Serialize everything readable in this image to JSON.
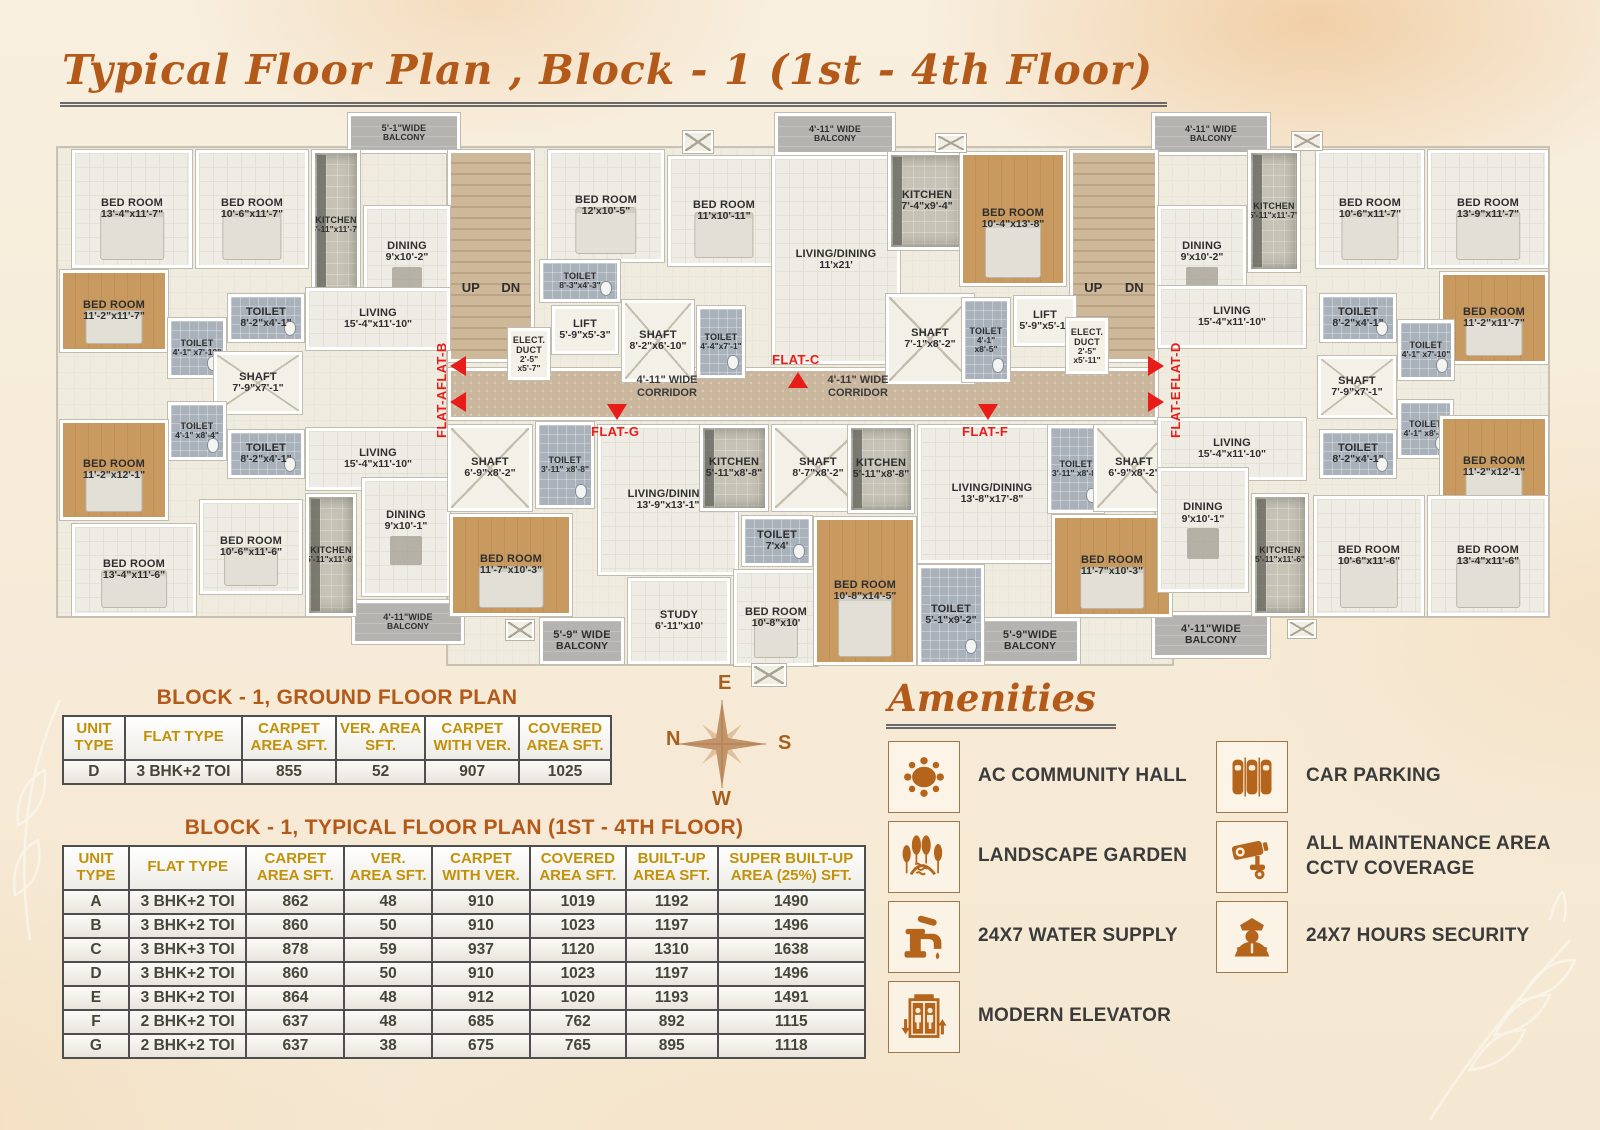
{
  "title": "Typical Floor Plan , Block - 1  (1st - 4th Floor)",
  "colors": {
    "accent": "#b35a1b",
    "red": "#e81c18",
    "table_header": "#c19209",
    "icon_brown": "#b5641c"
  },
  "floor_plan": {
    "bases": [
      {
        "x": 56,
        "y": 146,
        "w": 398,
        "h": 472
      },
      {
        "x": 446,
        "y": 146,
        "w": 714,
        "h": 262
      },
      {
        "x": 446,
        "y": 408,
        "w": 728,
        "h": 258
      },
      {
        "x": 1154,
        "y": 146,
        "w": 396,
        "h": 472
      }
    ],
    "stairs": [
      {
        "x": 448,
        "y": 150,
        "w": 86,
        "h": 212,
        "up": "UP",
        "dn": "DN"
      },
      {
        "x": 1070,
        "y": 150,
        "w": 88,
        "h": 212,
        "up": "UP",
        "dn": "DN"
      }
    ],
    "corridor": {
      "x": 448,
      "y": 368,
      "w": 710,
      "h": 52,
      "label": "4'-11\" WIDE CORRIDOR",
      "label_centers": [
        667,
        858
      ]
    },
    "rooms": [
      {
        "n": "BED ROOM",
        "d": "13'-4\"x11'-7\"",
        "x": 72,
        "y": 150,
        "w": 120,
        "h": 118,
        "t": "floor"
      },
      {
        "n": "BED ROOM",
        "d": "10'-6\"x11'-7\"",
        "x": 196,
        "y": 150,
        "w": 112,
        "h": 118,
        "t": "floor"
      },
      {
        "n": "KITCHEN",
        "d": "5'-11\"x11'-7\"",
        "x": 312,
        "y": 150,
        "w": 48,
        "h": 150,
        "t": "kitchen"
      },
      {
        "n": "DINING",
        "d": "9'x10'-2\"",
        "x": 364,
        "y": 206,
        "w": 86,
        "h": 126,
        "t": "floor",
        "c": "dining"
      },
      {
        "n": "BED ROOM",
        "d": "11'-2\"x11'-7\"",
        "x": 60,
        "y": 270,
        "w": 108,
        "h": 82,
        "t": "wood"
      },
      {
        "n": "TOILET",
        "d": "8'-2\"x4'-1\"",
        "x": 228,
        "y": 294,
        "w": 76,
        "h": 48,
        "t": "tile"
      },
      {
        "n": "TOILET",
        "d": "4'-1\" x7'-10\"",
        "x": 168,
        "y": 318,
        "w": 58,
        "h": 60,
        "t": "tile"
      },
      {
        "n": "LIVING",
        "d": "15'-4\"x11'-10\"",
        "x": 306,
        "y": 288,
        "w": 144,
        "h": 62,
        "t": "floor"
      },
      {
        "n": "SHAFT",
        "d": "7'-9\"x7'-1\"",
        "x": 214,
        "y": 352,
        "w": 88,
        "h": 62,
        "t": "shaft"
      },
      {
        "n": "TOILET",
        "d": "4'-1\" x8'-4\"",
        "x": 168,
        "y": 402,
        "w": 58,
        "h": 58,
        "t": "tile"
      },
      {
        "n": "TOILET",
        "d": "8'-2\"x4'-1\"",
        "x": 228,
        "y": 430,
        "w": 76,
        "h": 48,
        "t": "tile"
      },
      {
        "n": "BED ROOM",
        "d": "11'-2\"x12'-1\"",
        "x": 60,
        "y": 420,
        "w": 108,
        "h": 100,
        "t": "wood"
      },
      {
        "n": "LIVING",
        "d": "15'-4\"x11'-10\"",
        "x": 306,
        "y": 428,
        "w": 144,
        "h": 62,
        "t": "floor"
      },
      {
        "n": "DINING",
        "d": "9'x10'-1\"",
        "x": 362,
        "y": 478,
        "w": 88,
        "h": 118,
        "t": "floor",
        "c": "dining"
      },
      {
        "n": "BED ROOM",
        "d": "13'-4\"x11'-6\"",
        "x": 72,
        "y": 524,
        "w": 124,
        "h": 92,
        "t": "floor"
      },
      {
        "n": "BED ROOM",
        "d": "10'-6\"x11'-6\"",
        "x": 200,
        "y": 500,
        "w": 102,
        "h": 94,
        "t": "floor"
      },
      {
        "n": "KITCHEN",
        "d": "5'-11\"x11'-6\"",
        "x": 306,
        "y": 494,
        "w": 50,
        "h": 122,
        "t": "kitchen"
      },
      {
        "n": "BED ROOM",
        "d": "12'x10'-5\"",
        "x": 548,
        "y": 150,
        "w": 116,
        "h": 112,
        "t": "floor"
      },
      {
        "n": "BED ROOM",
        "d": "11'x10'-11\"",
        "x": 668,
        "y": 156,
        "w": 112,
        "h": 110,
        "t": "floor"
      },
      {
        "n": "TOILET",
        "d": "8'-3\"x4'-3\"",
        "x": 540,
        "y": 260,
        "w": 80,
        "h": 42,
        "t": "tile"
      },
      {
        "n": "LIFT",
        "d": "5'-9\"x5'-3\"",
        "x": 552,
        "y": 306,
        "w": 66,
        "h": 48,
        "t": "lift"
      },
      {
        "n": "ELECT. DUCT",
        "d": "2'-5\" x5'-7\"",
        "x": 508,
        "y": 328,
        "w": 42,
        "h": 52,
        "t": "lift"
      },
      {
        "n": "SHAFT",
        "d": "8'-2\"x6'-10\"",
        "x": 622,
        "y": 300,
        "w": 72,
        "h": 82,
        "t": "shaft"
      },
      {
        "n": "TOILET",
        "d": "4'-4\"x7'-1\"",
        "x": 697,
        "y": 306,
        "w": 48,
        "h": 72,
        "t": "tile"
      },
      {
        "n": "LIVING/DINING",
        "d": "11'x21'",
        "x": 772,
        "y": 156,
        "w": 128,
        "h": 208,
        "t": "floor"
      },
      {
        "n": "KITCHEN",
        "d": "7'-4\"x9'-4\"",
        "x": 888,
        "y": 152,
        "w": 78,
        "h": 98,
        "t": "kitchen"
      },
      {
        "n": "BED ROOM",
        "d": "10'-4\"x13'-8\"",
        "x": 960,
        "y": 152,
        "w": 106,
        "h": 134,
        "t": "wood"
      },
      {
        "n": "SHAFT",
        "d": "7'-1\"x8'-2\"",
        "x": 886,
        "y": 294,
        "w": 88,
        "h": 90,
        "t": "shaft"
      },
      {
        "n": "TOILET",
        "d": "4'-1\" x8'-5\"",
        "x": 962,
        "y": 298,
        "w": 48,
        "h": 84,
        "t": "tile"
      },
      {
        "n": "LIFT",
        "d": "5'-9\"x5'-1\"",
        "x": 1014,
        "y": 296,
        "w": 62,
        "h": 50,
        "t": "lift"
      },
      {
        "n": "ELECT. DUCT",
        "d": "2'-5\" x5'-11\"",
        "x": 1066,
        "y": 318,
        "w": 42,
        "h": 56,
        "t": "lift"
      },
      {
        "n": "SHAFT",
        "d": "6'-9\"x8'-2\"",
        "x": 448,
        "y": 425,
        "w": 84,
        "h": 86,
        "t": "shaft"
      },
      {
        "n": "TOILET",
        "d": "3'-11\" x8'-8\"",
        "x": 536,
        "y": 422,
        "w": 58,
        "h": 86,
        "t": "tile"
      },
      {
        "n": "BED ROOM",
        "d": "11'-7\"x10'-3\"",
        "x": 450,
        "y": 514,
        "w": 122,
        "h": 102,
        "t": "wood"
      },
      {
        "n": "LIVING/DINING",
        "d": "13'-9\"x13'-1\"",
        "x": 598,
        "y": 425,
        "w": 140,
        "h": 150,
        "t": "floor"
      },
      {
        "n": "KITCHEN",
        "d": "5'-11\"x8'-8\"",
        "x": 700,
        "y": 425,
        "w": 68,
        "h": 86,
        "t": "kitchen"
      },
      {
        "n": "SHAFT",
        "d": "8'-7\"x8'-2\"",
        "x": 772,
        "y": 425,
        "w": 92,
        "h": 86,
        "t": "shaft"
      },
      {
        "n": "TOILET",
        "d": "7'x4'",
        "x": 742,
        "y": 516,
        "w": 70,
        "h": 50,
        "t": "tile"
      },
      {
        "n": "STUDY",
        "d": "6'-11\"x10'",
        "x": 628,
        "y": 578,
        "w": 102,
        "h": 86,
        "t": "floor"
      },
      {
        "n": "BED ROOM",
        "d": "10'-8\"x10'",
        "x": 734,
        "y": 570,
        "w": 84,
        "h": 96,
        "t": "floor"
      },
      {
        "n": "KITCHEN",
        "d": "5'-11\"x8'-8\"",
        "x": 848,
        "y": 425,
        "w": 66,
        "h": 88,
        "t": "kitchen"
      },
      {
        "n": "LIVING/DINING",
        "d": "13'-8\"x17'-8\"",
        "x": 918,
        "y": 425,
        "w": 148,
        "h": 138,
        "t": "floor"
      },
      {
        "n": "TOILET",
        "d": "3'-11\" x8'-8\"",
        "x": 1048,
        "y": 425,
        "w": 56,
        "h": 88,
        "t": "tile"
      },
      {
        "n": "SHAFT",
        "d": "6'-9\"x8'-2\"",
        "x": 1094,
        "y": 425,
        "w": 80,
        "h": 86,
        "t": "shaft"
      },
      {
        "n": "BED ROOM",
        "d": "10'-8\"x14'-5\"",
        "x": 814,
        "y": 517,
        "w": 102,
        "h": 148,
        "t": "wood"
      },
      {
        "n": "BED ROOM",
        "d": "11'-7\"x10'-3\"",
        "x": 1052,
        "y": 515,
        "w": 120,
        "h": 102,
        "t": "wood"
      },
      {
        "n": "TOILET",
        "d": "5'-1\"x9'-2\"",
        "x": 918,
        "y": 565,
        "w": 66,
        "h": 100,
        "t": "tile"
      },
      {
        "n": "KITCHEN",
        "d": "5'-11\"x11'-7\"",
        "x": 1248,
        "y": 150,
        "w": 52,
        "h": 122,
        "t": "kitchen"
      },
      {
        "n": "DINING",
        "d": "9'x10'-2\"",
        "x": 1158,
        "y": 206,
        "w": 88,
        "h": 126,
        "t": "floor",
        "c": "dining"
      },
      {
        "n": "BED ROOM",
        "d": "10'-6\"x11'-7\"",
        "x": 1316,
        "y": 150,
        "w": 108,
        "h": 118,
        "t": "floor"
      },
      {
        "n": "BED ROOM",
        "d": "13'-9\"x11'-7\"",
        "x": 1428,
        "y": 150,
        "w": 120,
        "h": 118,
        "t": "floor"
      },
      {
        "n": "BED ROOM",
        "d": "11'-2\"x11'-7\"",
        "x": 1440,
        "y": 272,
        "w": 108,
        "h": 92,
        "t": "wood"
      },
      {
        "n": "LIVING",
        "d": "15'-4\"x11'-10\"",
        "x": 1158,
        "y": 286,
        "w": 148,
        "h": 62,
        "t": "floor"
      },
      {
        "n": "TOILET",
        "d": "8'-2\"x4'-1\"",
        "x": 1320,
        "y": 294,
        "w": 76,
        "h": 48,
        "t": "tile"
      },
      {
        "n": "TOILET",
        "d": "4'-1\" x7'-10\"",
        "x": 1398,
        "y": 320,
        "w": 56,
        "h": 60,
        "t": "tile"
      },
      {
        "n": "SHAFT",
        "d": "7'-9\"x7'-1\"",
        "x": 1318,
        "y": 356,
        "w": 78,
        "h": 62,
        "t": "shaft"
      },
      {
        "n": "LIVING",
        "d": "15'-4\"x11'-10\"",
        "x": 1158,
        "y": 418,
        "w": 148,
        "h": 62,
        "t": "floor"
      },
      {
        "n": "TOILET",
        "d": "4'-1\" x8'-4\"",
        "x": 1398,
        "y": 400,
        "w": 55,
        "h": 58,
        "t": "tile"
      },
      {
        "n": "TOILET",
        "d": "8'-2\"x4'-1\"",
        "x": 1320,
        "y": 430,
        "w": 76,
        "h": 48,
        "t": "tile"
      },
      {
        "n": "BED ROOM",
        "d": "11'-2\"x12'-1\"",
        "x": 1440,
        "y": 416,
        "w": 108,
        "h": 102,
        "t": "wood"
      },
      {
        "n": "DINING",
        "d": "9'x10'-1\"",
        "x": 1158,
        "y": 468,
        "w": 90,
        "h": 124,
        "t": "floor",
        "c": "dining"
      },
      {
        "n": "KITCHEN",
        "d": "5'-11\"x11'-6\"",
        "x": 1252,
        "y": 494,
        "w": 56,
        "h": 122,
        "t": "kitchen"
      },
      {
        "n": "BED ROOM",
        "d": "10'-6\"x11'-6\"",
        "x": 1314,
        "y": 496,
        "w": 110,
        "h": 120,
        "t": "floor"
      },
      {
        "n": "BED ROOM",
        "d": "13'-4\"x11'-6\"",
        "x": 1428,
        "y": 496,
        "w": 120,
        "h": 120,
        "t": "floor"
      },
      {
        "n": "5'-1\"WIDE",
        "d": "BALCONY",
        "x": 348,
        "y": 113,
        "w": 112,
        "h": 40,
        "t": "balcony"
      },
      {
        "n": "4'-11\" WIDE",
        "d": "BALCONY",
        "x": 775,
        "y": 113,
        "w": 120,
        "h": 42,
        "t": "balcony"
      },
      {
        "n": "4'-11\" WIDE",
        "d": "BALCONY",
        "x": 1152,
        "y": 113,
        "w": 118,
        "h": 42,
        "t": "balcony"
      },
      {
        "n": "4'-11\"WIDE",
        "d": "BALCONY",
        "x": 352,
        "y": 600,
        "w": 112,
        "h": 44,
        "t": "balcony"
      },
      {
        "n": "5'-9\" WIDE",
        "d": "BALCONY",
        "x": 540,
        "y": 618,
        "w": 84,
        "h": 46,
        "t": "balcony"
      },
      {
        "n": "5'-9\"WIDE",
        "d": "BALCONY",
        "x": 980,
        "y": 618,
        "w": 100,
        "h": 46,
        "t": "balcony"
      },
      {
        "n": "4'-11\"WIDE",
        "d": "BALCONY",
        "x": 1152,
        "y": 612,
        "w": 118,
        "h": 46,
        "t": "balcony"
      }
    ],
    "markers": [
      {
        "label": "FLAT-B",
        "x": 434,
        "y": 338,
        "vertical": true,
        "dir": "left",
        "tx": 450,
        "ty": 356
      },
      {
        "label": "FLAT-A",
        "x": 434,
        "y": 386,
        "vertical": true,
        "dir": "left",
        "tx": 450,
        "ty": 392
      },
      {
        "label": "FLAT-C",
        "x": 772,
        "y": 352,
        "vertical": false,
        "dir": "up",
        "tx": 788,
        "ty": 372
      },
      {
        "label": "FLAT-G",
        "x": 591,
        "y": 424,
        "vertical": false,
        "dir": "down",
        "tx": 607,
        "ty": 404
      },
      {
        "label": "FLAT-F",
        "x": 962,
        "y": 424,
        "vertical": false,
        "dir": "down",
        "tx": 978,
        "ty": 404
      },
      {
        "label": "FLAT-D",
        "x": 1168,
        "y": 338,
        "vertical": true,
        "dir": "right",
        "tx": 1148,
        "ty": 356
      },
      {
        "label": "FLAT-E",
        "x": 1168,
        "y": 386,
        "vertical": true,
        "dir": "right",
        "tx": 1148,
        "ty": 392
      }
    ],
    "vents": [
      {
        "x": 683,
        "y": 131,
        "w": 30,
        "h": 22
      },
      {
        "x": 936,
        "y": 134,
        "w": 30,
        "h": 18
      },
      {
        "x": 1292,
        "y": 132,
        "w": 30,
        "h": 18
      },
      {
        "x": 506,
        "y": 620,
        "w": 28,
        "h": 20
      },
      {
        "x": 752,
        "y": 664,
        "w": 34,
        "h": 22
      },
      {
        "x": 1288,
        "y": 620,
        "w": 28,
        "h": 18
      }
    ]
  },
  "ground_table": {
    "title": "BLOCK - 1, GROUND FLOOR PLAN",
    "headers": [
      "UNIT TYPE",
      "FLAT TYPE",
      "CARPET AREA SFT.",
      "VER. AREA SFT.",
      "CARPET WITH VER.",
      "COVERED AREA SFT."
    ],
    "rows": [
      [
        "D",
        "3 BHK+2 TOI",
        "855",
        "52",
        "907",
        "1025"
      ]
    ]
  },
  "typical_table": {
    "title": "BLOCK - 1, TYPICAL FLOOR PLAN (1ST - 4TH FLOOR)",
    "headers": [
      "UNIT TYPE",
      "FLAT TYPE",
      "CARPET AREA SFT.",
      "VER. AREA SFT.",
      "CARPET WITH VER.",
      "COVERED AREA SFT.",
      "BUILT-UP AREA SFT.",
      "SUPER BUILT-UP AREA (25%) SFT."
    ],
    "rows": [
      [
        "A",
        "3 BHK+2 TOI",
        "862",
        "48",
        "910",
        "1019",
        "1192",
        "1490"
      ],
      [
        "B",
        "3 BHK+2 TOI",
        "860",
        "50",
        "910",
        "1023",
        "1197",
        "1496"
      ],
      [
        "C",
        "3 BHK+3 TOI",
        "878",
        "59",
        "937",
        "1120",
        "1310",
        "1638"
      ],
      [
        "D",
        "3 BHK+2 TOI",
        "860",
        "50",
        "910",
        "1023",
        "1197",
        "1496"
      ],
      [
        "E",
        "3 BHK+2 TOI",
        "864",
        "48",
        "912",
        "1020",
        "1193",
        "1491"
      ],
      [
        "F",
        "2 BHK+2 TOI",
        "637",
        "48",
        "685",
        "762",
        "892",
        "1115"
      ],
      [
        "G",
        "2 BHK+2 TOI",
        "637",
        "38",
        "675",
        "765",
        "895",
        "1118"
      ]
    ]
  },
  "compass": {
    "east": "E",
    "west": "W",
    "north": "N",
    "south": "S"
  },
  "amenities": {
    "title": "Amenities",
    "items": [
      {
        "icon": "community-table-icon",
        "label": "AC COMMUNITY HALL"
      },
      {
        "icon": "car-parking-icon",
        "label": "CAR PARKING"
      },
      {
        "icon": "landscape-garden-icon",
        "label": "LANDSCAPE GARDEN"
      },
      {
        "icon": "cctv-camera-icon",
        "label": "ALL MAINTENANCE AREA CCTV COVERAGE"
      },
      {
        "icon": "water-tap-icon",
        "label": "24X7 WATER SUPPLY"
      },
      {
        "icon": "security-guard-icon",
        "label": "24X7 HOURS SECURITY"
      },
      {
        "icon": "elevator-icon",
        "label": "MODERN ELEVATOR"
      }
    ]
  }
}
